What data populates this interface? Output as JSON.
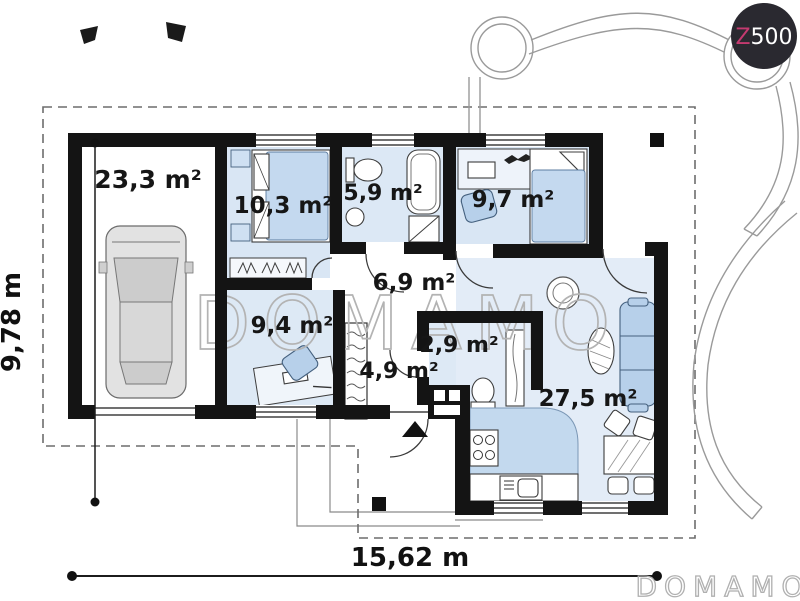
{
  "plan": {
    "rooms": [
      {
        "id": "garage",
        "area": "23,3 m²"
      },
      {
        "id": "bedroom-1",
        "area": "10,3 m²"
      },
      {
        "id": "bathroom",
        "area": "5,9 m²"
      },
      {
        "id": "bedroom-2",
        "area": "9,7 m²"
      },
      {
        "id": "hall",
        "area": "6,9 m²"
      },
      {
        "id": "bedroom-3",
        "area": "9,4 m²"
      },
      {
        "id": "corridor",
        "area": "4,9 m²"
      },
      {
        "id": "wc",
        "area": "2,9 m²"
      },
      {
        "id": "living-kitchen",
        "area": "27,5 m²"
      }
    ],
    "dimensions": {
      "width": "15,62 m",
      "height": "9,78 m"
    }
  },
  "watermarks": {
    "center": "DOMAMO",
    "corner": "DOMAMO"
  },
  "logo": {
    "z": "Z",
    "number": "500"
  },
  "colors": {
    "wall": "#141414",
    "floor_blue": "#dbe7f4",
    "living_floor": "#e3ecf7",
    "furniture_blue": "#b7d0ea",
    "kitchen_counter": "#c3d9ee",
    "logo_background": "#2a2930",
    "logo_accent": "#c43a70",
    "watermark_gray": "#b3b3b3"
  }
}
